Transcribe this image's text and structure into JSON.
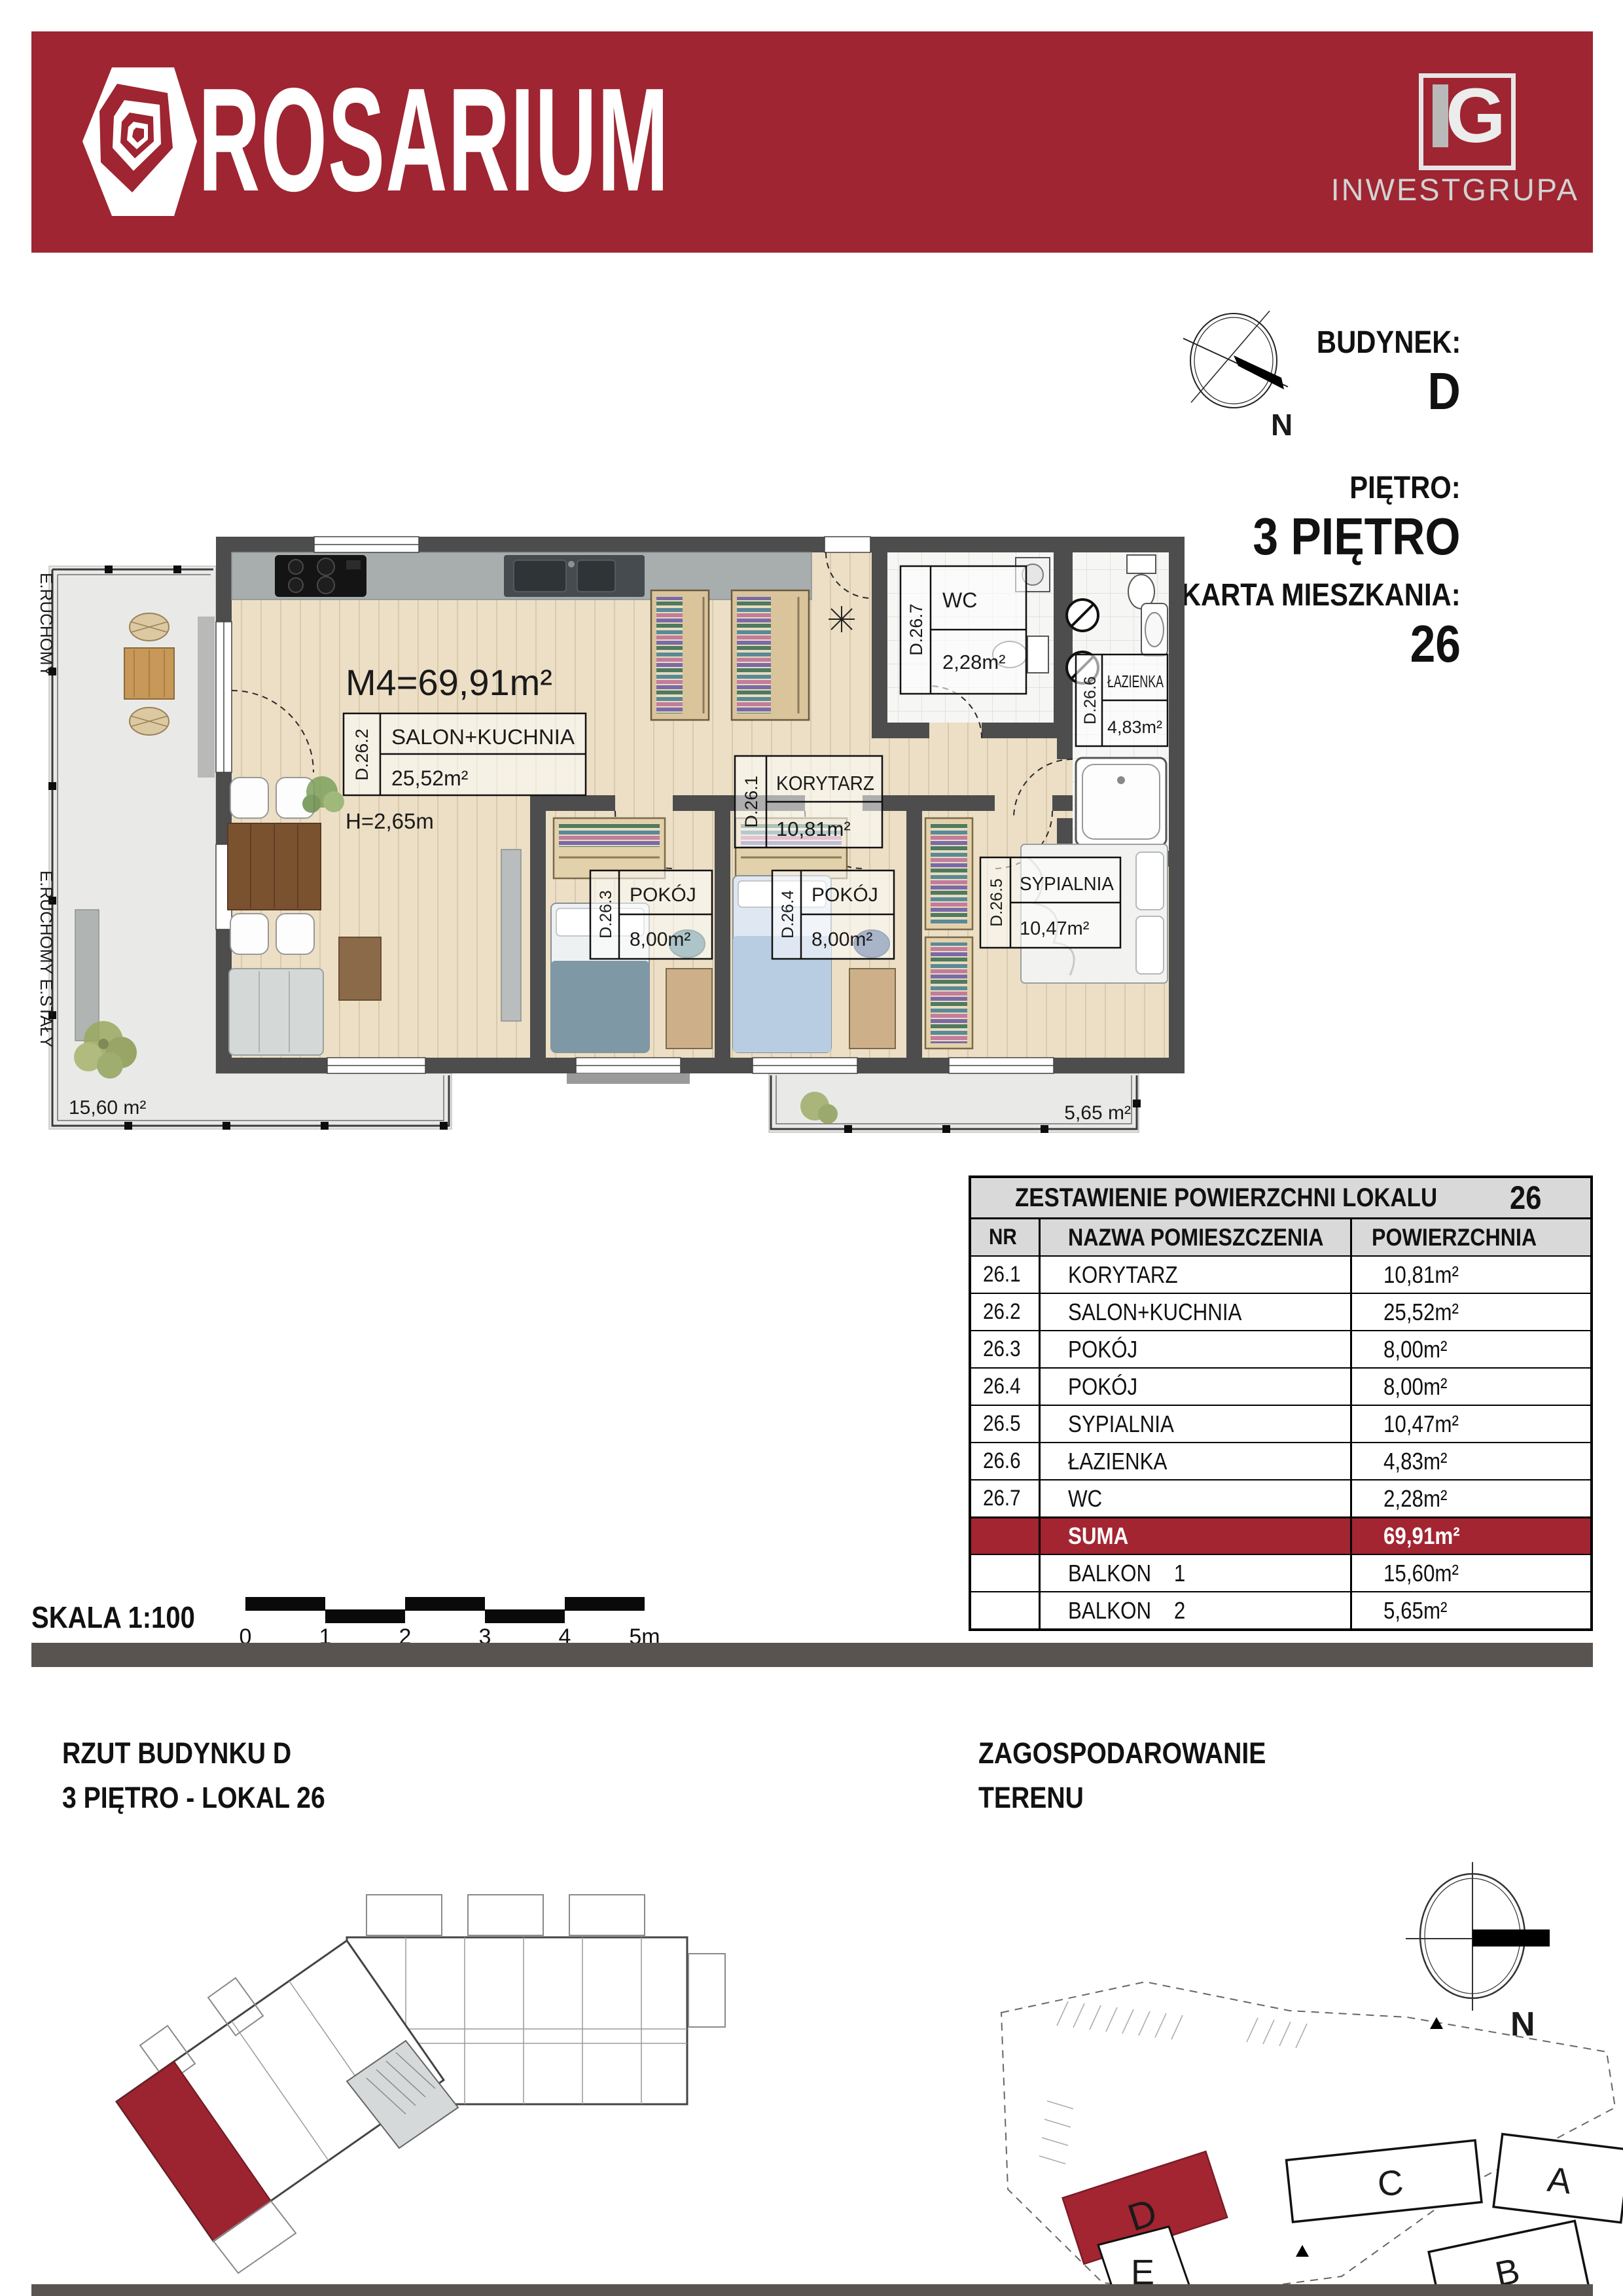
{
  "brand": {
    "name": "ROSARIUM",
    "company": "INWESTGRUPA",
    "company_monogram": "G",
    "colors": {
      "brand_red": "#9e2531",
      "suma_red": "#a32531"
    }
  },
  "header_info": {
    "building_label": "BUDYNEK:",
    "building": "D",
    "floor_label": "PIĘTRO:",
    "floor": "3 PIĘTRO",
    "card_label": "KARTA MIESZKANIA:",
    "card": "26",
    "compass_letter": "N"
  },
  "plan": {
    "m4_label": "M4=69,91m²",
    "height_label": "H=2,65m",
    "rooms": [
      {
        "id": "D.26.2",
        "name": "SALON+KUCHNIA",
        "area": "25,52m²"
      },
      {
        "id": "D.26.1",
        "name": "KORYTARZ",
        "area": "10,81m²"
      },
      {
        "id": "D.26.7",
        "name": "WC",
        "area": "2,28m²"
      },
      {
        "id": "D.26.6",
        "name": "ŁAZIENKA",
        "area": "4,83m²"
      },
      {
        "id": "D.26.3",
        "name": "POKÓJ",
        "area": "8,00m²"
      },
      {
        "id": "D.26.4",
        "name": "POKÓJ",
        "area": "8,00m²"
      },
      {
        "id": "D.26.5",
        "name": "SYPIALNIA",
        "area": "10,47m²"
      }
    ],
    "balcony1_area": "15,60 m²",
    "balcony2_area": "5,65 m²",
    "wall_label_top": "E.RUCHOMY",
    "wall_label_bottom": "E.RUCHOMY E.STAŁY"
  },
  "table": {
    "title": "ZESTAWIENIE POWIERZCHNI LOKALU",
    "title_number": "26",
    "columns": [
      "NR",
      "NAZWA POMIESZCZENIA",
      "POWIERZCHNIA"
    ],
    "rows": [
      {
        "nr": "26.1",
        "name": "KORYTARZ",
        "area": "10,81m²"
      },
      {
        "nr": "26.2",
        "name": "SALON+KUCHNIA",
        "area": "25,52m²"
      },
      {
        "nr": "26.3",
        "name": "POKÓJ",
        "area": "8,00m²"
      },
      {
        "nr": "26.4",
        "name": "POKÓJ",
        "area": "8,00m²"
      },
      {
        "nr": "26.5",
        "name": "SYPIALNIA",
        "area": "10,47m²"
      },
      {
        "nr": "26.6",
        "name": "ŁAZIENKA",
        "area": "4,83m²"
      },
      {
        "nr": "26.7",
        "name": "WC",
        "area": "2,28m²"
      }
    ],
    "suma": {
      "label": "SUMA",
      "area": "69,91m²"
    },
    "extra": [
      {
        "name": "BALKON    1",
        "area": "15,60m²"
      },
      {
        "name": "BALKON    2",
        "area": "5,65m²"
      }
    ]
  },
  "scale": {
    "label": "SKALA 1:100",
    "ticks": [
      "0",
      "1",
      "2",
      "3",
      "4",
      "5m"
    ]
  },
  "bottom_left": {
    "title_line1": "RZUT BUDYNKU D",
    "title_line2": "3 PIĘTRO - LOKAL 26"
  },
  "bottom_right": {
    "title_line1": "ZAGOSPODAROWANIE",
    "title_line2": "TERENU",
    "buildings": [
      "A",
      "B",
      "C",
      "D",
      "E"
    ],
    "compass_letter": "N"
  }
}
